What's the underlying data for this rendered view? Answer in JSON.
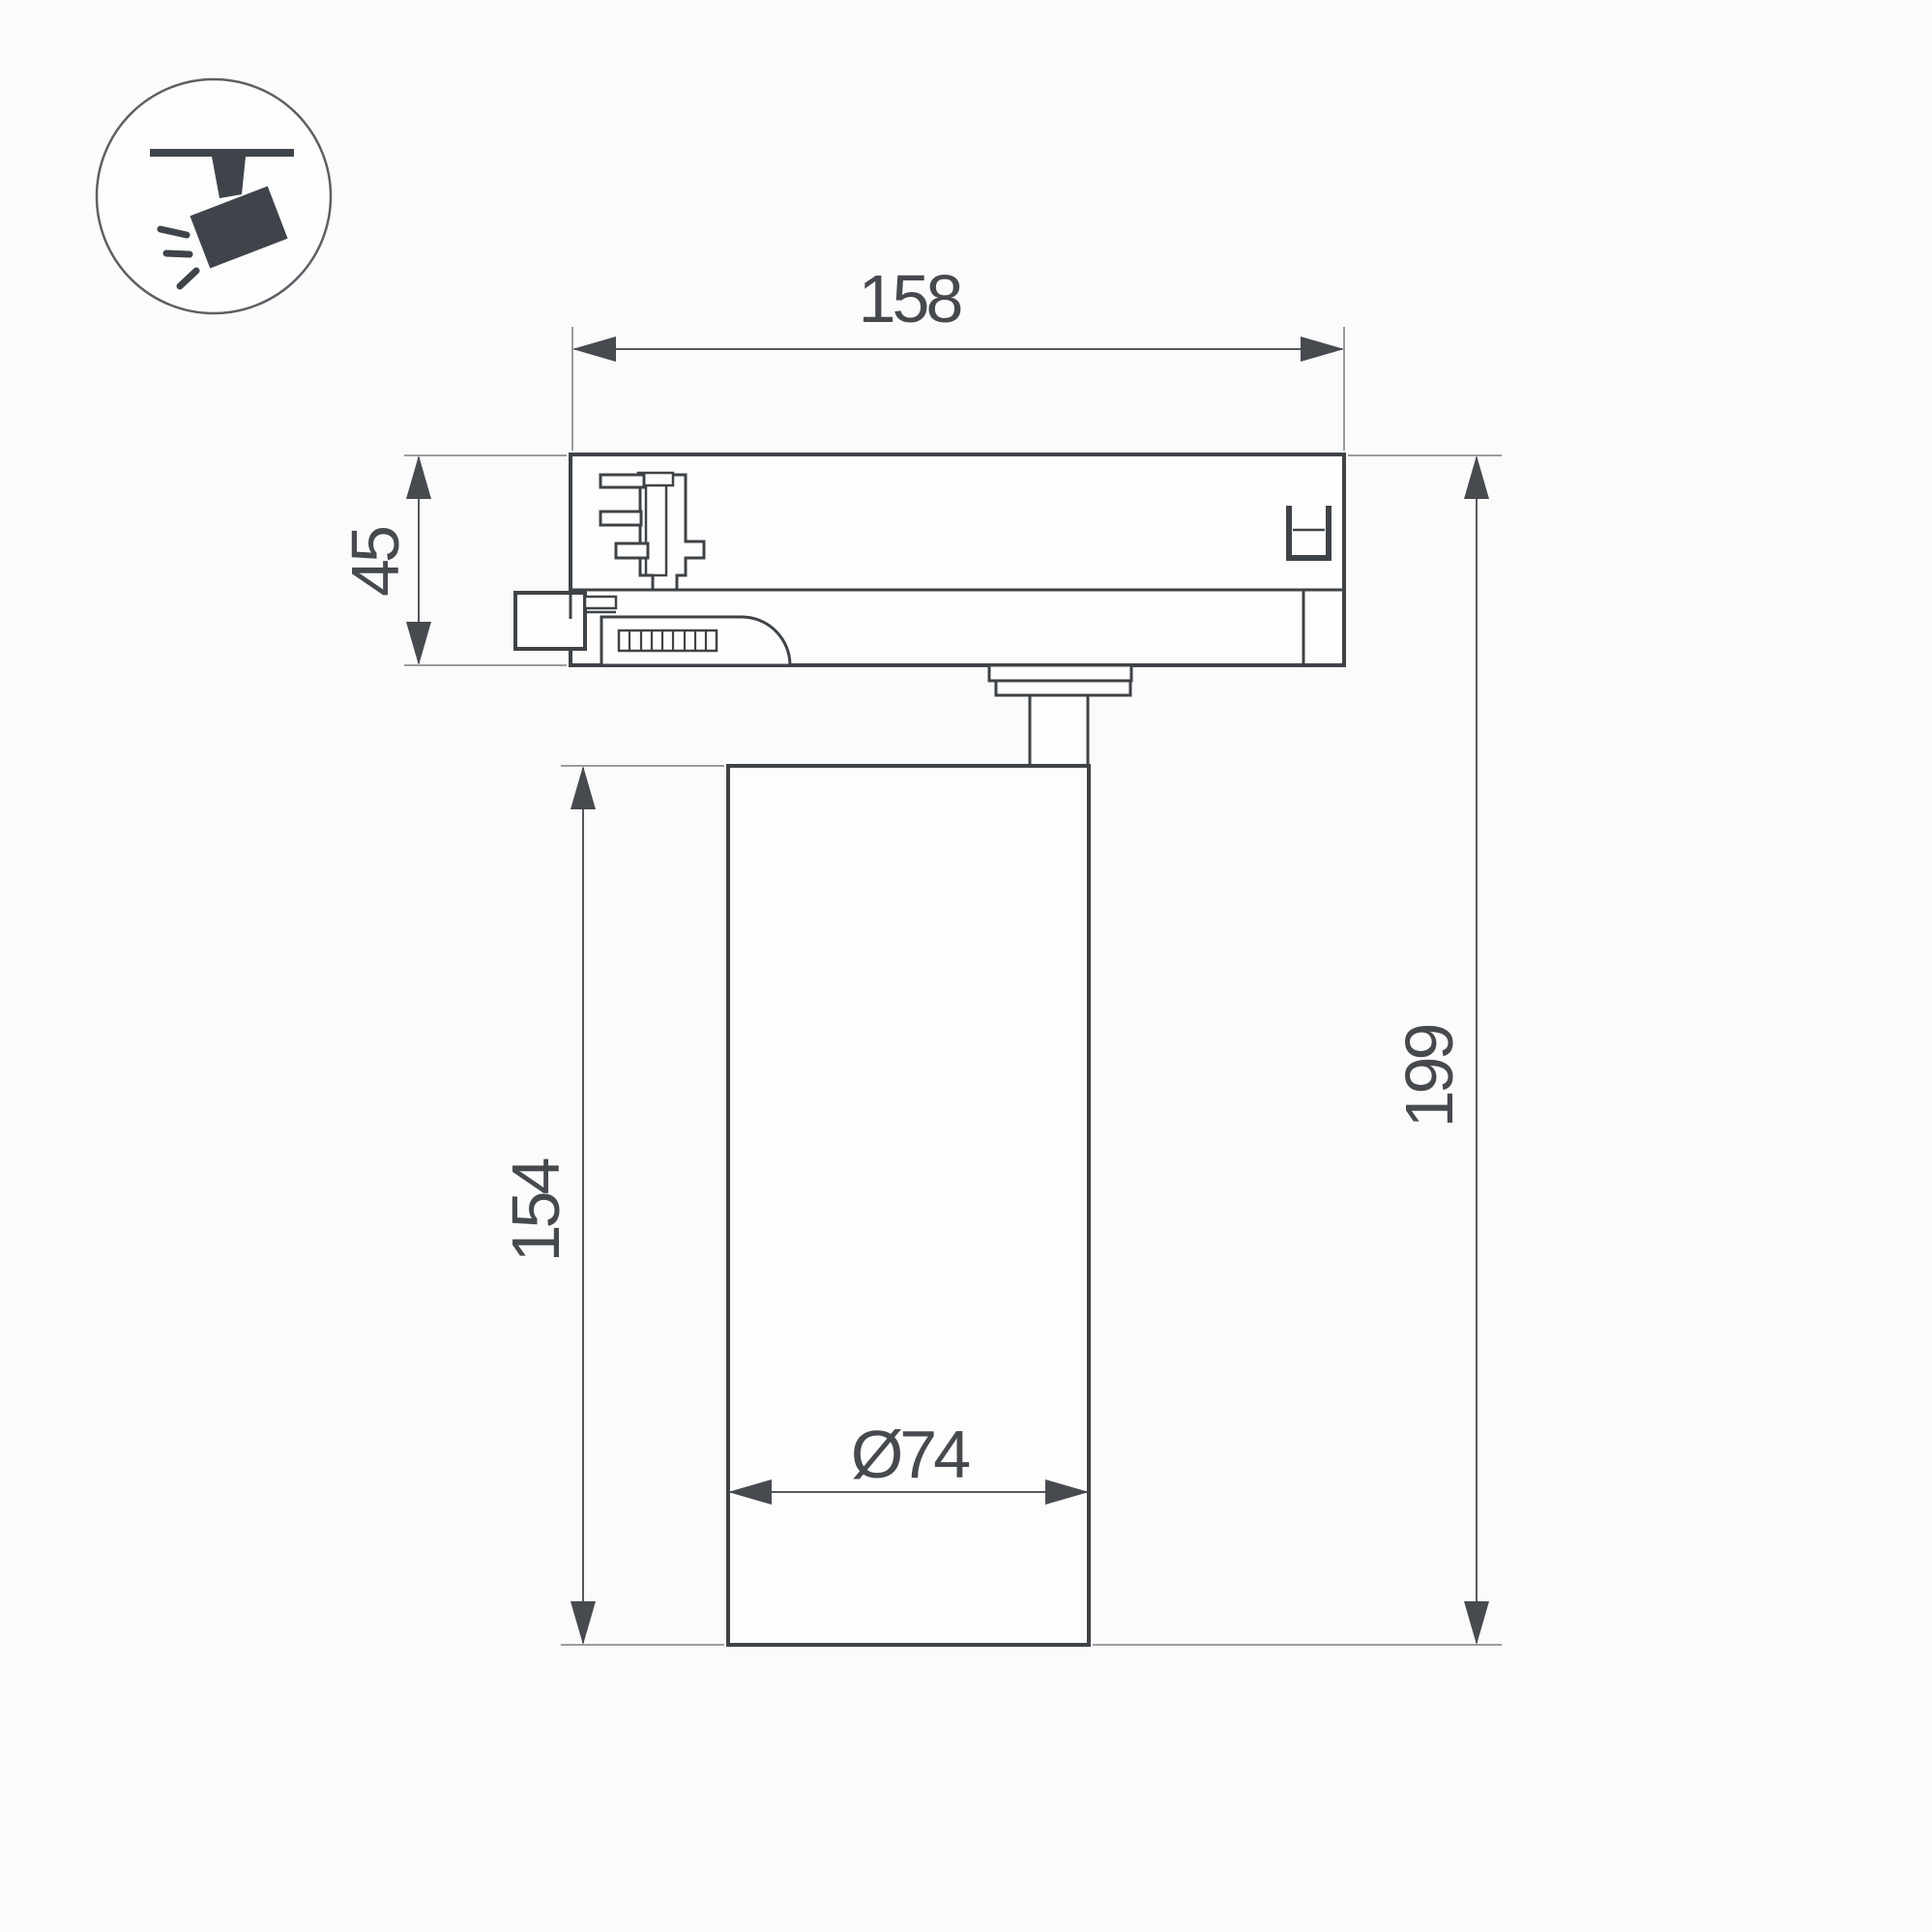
{
  "icon": {
    "name": "track-spotlight-pictogram",
    "description": "ceiling track rail with tilted spotlight emitting rays"
  },
  "drawing": {
    "type": "technical-dimension-drawing",
    "product": "track light fixture side view",
    "dimensions": {
      "width_top": "158",
      "adapter_height": "45",
      "body_height": "154",
      "total_height": "199",
      "diameter": "Ø74"
    },
    "colors": {
      "outline": "#3e4347",
      "dimension_line": "#55595d",
      "extension_line": "#8b8f93",
      "arrow": "#474b50",
      "text": "#46494d",
      "background": "#fbfbfc",
      "fill": "#fdfdfe",
      "icon_glyph": "#3f444a"
    }
  }
}
